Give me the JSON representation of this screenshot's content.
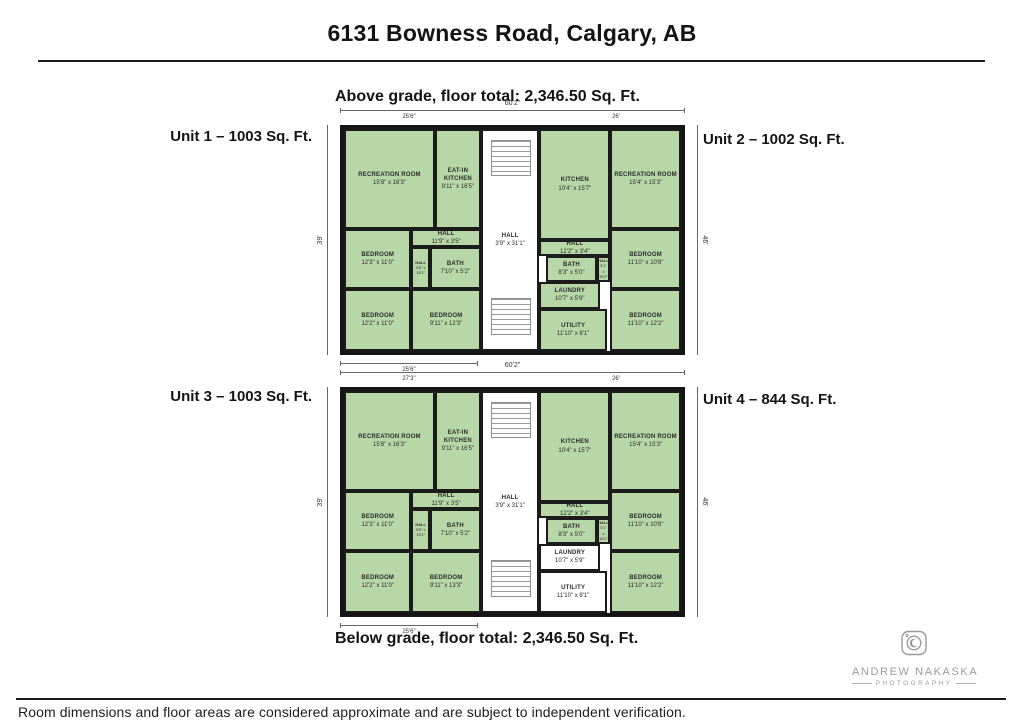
{
  "page": {
    "title": "6131 Bowness Road, Calgary, AB",
    "disclaimer": "Room dimensions and floor areas are considered approximate and are subject to independent verification."
  },
  "colors": {
    "room_green": "#b7d7a6",
    "wall": "#141414",
    "dimension_line": "#666666",
    "watermark_gray": "#9b9b9b"
  },
  "watermark": {
    "icon": "camera-icon",
    "line1": "ANDREW NAKASKA",
    "line2": "PHOTOGRAPHY"
  },
  "plans": [
    {
      "id": "above-grade",
      "caption": "Above grade, floor total: 2,346.50 Sq. Ft.",
      "unit_left": "Unit 1 – 1003 Sq. Ft.",
      "unit_right": "Unit 2 – 1002 Sq. Ft.",
      "dims": {
        "top_overall": "60'2\"",
        "top_left": "25'6\"",
        "top_right": "26'",
        "left": "39'",
        "right": "46'",
        "bottom_left": "25'6\""
      },
      "stairs": [
        [
          43.5,
          5,
          12,
          16
        ],
        [
          43.5,
          76,
          12,
          17
        ]
      ],
      "rooms": [
        {
          "name": "RECREATION ROOM",
          "dims": "15'8\" x 16'3\"",
          "rect": [
            0,
            0,
            27,
            45
          ],
          "fill": "green"
        },
        {
          "name": "EAT-IN KITCHEN",
          "dims": "9'11\" x 16'5\"",
          "rect": [
            27,
            0,
            13.6,
            45
          ],
          "fill": "green"
        },
        {
          "name": "HALL",
          "dims": "11'9\" x 3'5\"",
          "rect": [
            20,
            45,
            20.6,
            8
          ],
          "fill": "green"
        },
        {
          "name": "BEDROOM",
          "dims": "12'3\" x 11'0\"",
          "rect": [
            0,
            45,
            20,
            27
          ],
          "fill": "green"
        },
        {
          "name": "HALL",
          "dims": "3'6\" x 15'1\"",
          "rect": [
            20,
            53,
            5.5,
            19
          ],
          "fill": "green",
          "small": true
        },
        {
          "name": "BATH",
          "dims": "7'10\" x 5'2\"",
          "rect": [
            25.5,
            53,
            15.1,
            19
          ],
          "fill": "green"
        },
        {
          "name": "BEDROOM",
          "dims": "12'2\" x 11'0\"",
          "rect": [
            0,
            72,
            20,
            28
          ],
          "fill": "green"
        },
        {
          "name": "BEDROOM",
          "dims": "9'11\" x 12'3\"",
          "rect": [
            20,
            72,
            20.6,
            28
          ],
          "fill": "green"
        },
        {
          "name": "HALL",
          "dims": "3'9\" x 31'1\"",
          "rect": [
            40.6,
            0,
            17.4,
            100
          ],
          "fill": "white"
        },
        {
          "name": "KITCHEN",
          "dims": "10'4\" x 15'7\"",
          "rect": [
            58,
            0,
            21,
            50
          ],
          "fill": "green"
        },
        {
          "name": "RECREATION ROOM",
          "dims": "15'4\" x 15'3\"",
          "rect": [
            79,
            0,
            21,
            45
          ],
          "fill": "green"
        },
        {
          "name": "HALL",
          "dims": "12'2\" x 3'4\"",
          "rect": [
            58,
            50,
            21,
            7
          ],
          "fill": "green"
        },
        {
          "name": "BATH",
          "dims": "8'3\" x 5'0\"",
          "rect": [
            60,
            57,
            15,
            12
          ],
          "fill": "green"
        },
        {
          "name": "HALL",
          "dims": "3'1\" x 15'2\"",
          "rect": [
            75,
            57,
            4,
            12
          ],
          "fill": "green",
          "small": true
        },
        {
          "name": "BEDROOM",
          "dims": "11'10\" x 10'8\"",
          "rect": [
            79,
            45,
            21,
            27
          ],
          "fill": "green"
        },
        {
          "name": "LAUNDRY",
          "dims": "10'7\" x 5'9\"",
          "rect": [
            58,
            69,
            18,
            12
          ],
          "fill": "green"
        },
        {
          "name": "UTILITY",
          "dims": "11'10\" x 8'1\"",
          "rect": [
            58,
            81,
            20,
            19
          ],
          "fill": "green"
        },
        {
          "name": "BEDROOM",
          "dims": "11'10\" x 12'2\"",
          "rect": [
            79,
            72,
            21,
            28
          ],
          "fill": "green"
        }
      ]
    },
    {
      "id": "below-grade",
      "caption": "Below grade, floor total: 2,346.50 Sq. Ft.",
      "unit_left": "Unit 3 – 1003 Sq. Ft.",
      "unit_right": "Unit 4 – 844 Sq. Ft.",
      "dims": {
        "top_overall": "60'2\"",
        "top_left": "27'3\"",
        "top_right": "26'",
        "left": "39'",
        "right": "46'",
        "bottom_left": "25'6\""
      },
      "stairs": [
        [
          43.5,
          5,
          12,
          16
        ],
        [
          43.5,
          76,
          12,
          17
        ]
      ],
      "rooms": [
        {
          "name": "RECREATION ROOM",
          "dims": "15'8\" x 16'3\"",
          "rect": [
            0,
            0,
            27,
            45
          ],
          "fill": "green"
        },
        {
          "name": "EAT-IN KITCHEN",
          "dims": "9'11\" x 16'5\"",
          "rect": [
            27,
            0,
            13.6,
            45
          ],
          "fill": "green"
        },
        {
          "name": "HALL",
          "dims": "11'9\" x 3'5\"",
          "rect": [
            20,
            45,
            20.6,
            8
          ],
          "fill": "green"
        },
        {
          "name": "BEDROOM",
          "dims": "12'3\" x 11'0\"",
          "rect": [
            0,
            45,
            20,
            27
          ],
          "fill": "green"
        },
        {
          "name": "HALL",
          "dims": "3'6\" x 15'1\"",
          "rect": [
            20,
            53,
            5.5,
            19
          ],
          "fill": "green",
          "small": true
        },
        {
          "name": "BATH",
          "dims": "7'10\" x 5'2\"",
          "rect": [
            25.5,
            53,
            15.1,
            19
          ],
          "fill": "green"
        },
        {
          "name": "BEDROOM",
          "dims": "12'2\" x 11'0\"",
          "rect": [
            0,
            72,
            20,
            28
          ],
          "fill": "green"
        },
        {
          "name": "BEDROOM",
          "dims": "9'11\" x 13'3\"",
          "rect": [
            20,
            72,
            20.6,
            28
          ],
          "fill": "green"
        },
        {
          "name": "HALL",
          "dims": "3'9\" x 31'1\"",
          "rect": [
            40.6,
            0,
            17.4,
            100
          ],
          "fill": "white"
        },
        {
          "name": "KITCHEN",
          "dims": "10'4\" x 15'7\"",
          "rect": [
            58,
            0,
            21,
            50
          ],
          "fill": "green"
        },
        {
          "name": "RECREATION ROOM",
          "dims": "15'4\" x 15'3\"",
          "rect": [
            79,
            0,
            21,
            45
          ],
          "fill": "green"
        },
        {
          "name": "HALL",
          "dims": "12'2\" x 3'4\"",
          "rect": [
            58,
            50,
            21,
            7
          ],
          "fill": "green"
        },
        {
          "name": "BATH",
          "dims": "8'3\" x 5'0\"",
          "rect": [
            60,
            57,
            15,
            12
          ],
          "fill": "green"
        },
        {
          "name": "HALL",
          "dims": "3'1\" x 15'2\"",
          "rect": [
            75,
            57,
            4,
            12
          ],
          "fill": "green",
          "small": true
        },
        {
          "name": "BEDROOM",
          "dims": "11'10\" x 10'8\"",
          "rect": [
            79,
            45,
            21,
            27
          ],
          "fill": "green"
        },
        {
          "name": "LAUNDRY",
          "dims": "10'7\" x 5'9\"",
          "rect": [
            58,
            69,
            18,
            12
          ],
          "fill": "white"
        },
        {
          "name": "UTILITY",
          "dims": "11'10\" x 8'1\"",
          "rect": [
            58,
            81,
            20,
            19
          ],
          "fill": "white"
        },
        {
          "name": "BEDROOM",
          "dims": "11'10\" x 12'2\"",
          "rect": [
            79,
            72,
            21,
            28
          ],
          "fill": "green"
        }
      ]
    }
  ]
}
